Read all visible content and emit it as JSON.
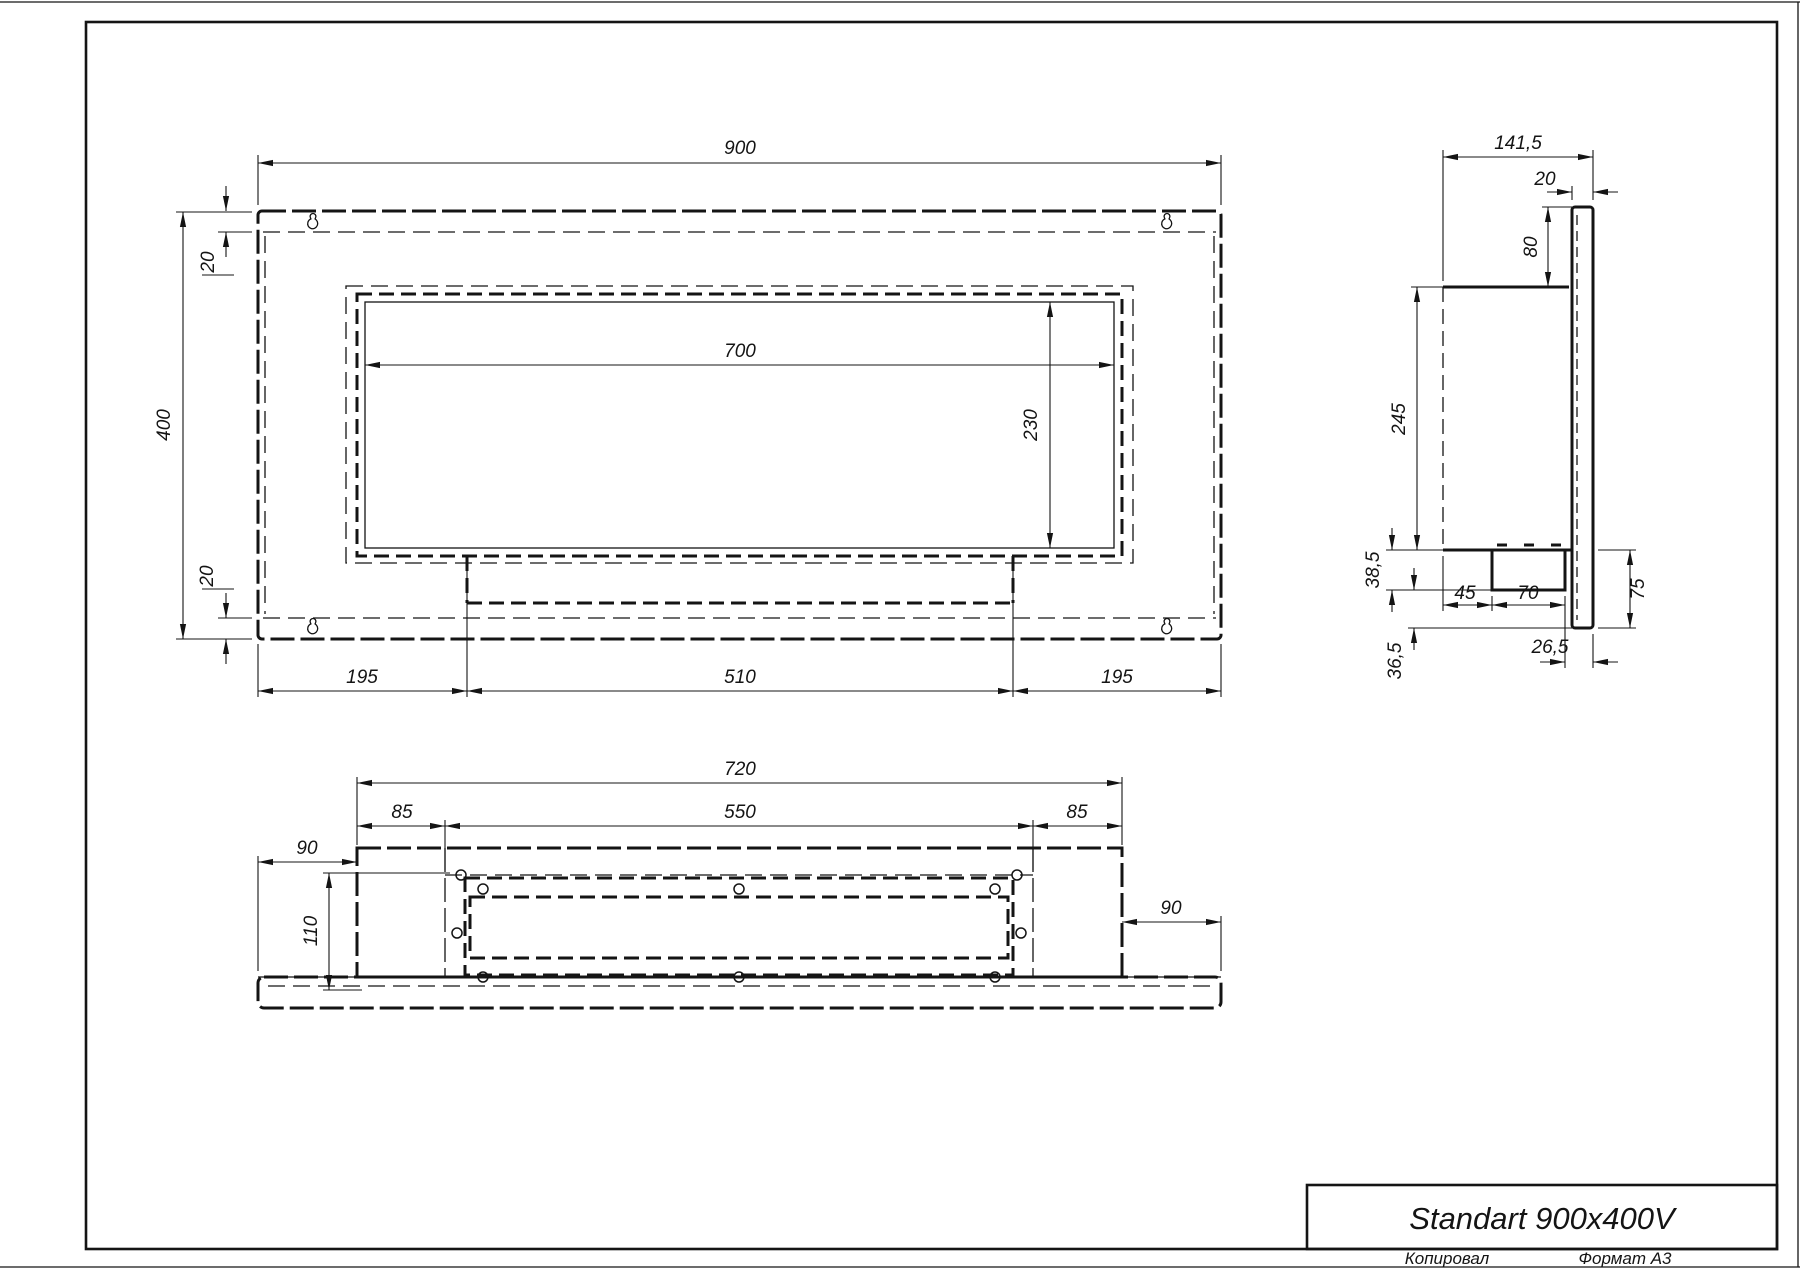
{
  "title_block": {
    "name": "Standart 900x400V",
    "copied": "Копировал",
    "format": "Формат A3"
  },
  "front_view": {
    "width": "900",
    "height": "400",
    "inset_top": "20",
    "inset_bottom": "20",
    "opening_width": "700",
    "opening_height": "230",
    "bottom_left": "195",
    "bottom_center": "510",
    "bottom_right": "195"
  },
  "side_view": {
    "depth": "141,5",
    "panel_thickness": "20",
    "top_offset": "80",
    "body_height": "245",
    "step": "38,5",
    "lower_step": "36,5",
    "burner_offset": "45",
    "burner_width": "70",
    "edge_offset": "26,5",
    "bracket": "75"
  },
  "bottom_view": {
    "width": "720",
    "opening": "550",
    "left_margin": "85",
    "right_margin": "85",
    "flange_left": "90",
    "flange_right": "90",
    "depth": "110"
  }
}
